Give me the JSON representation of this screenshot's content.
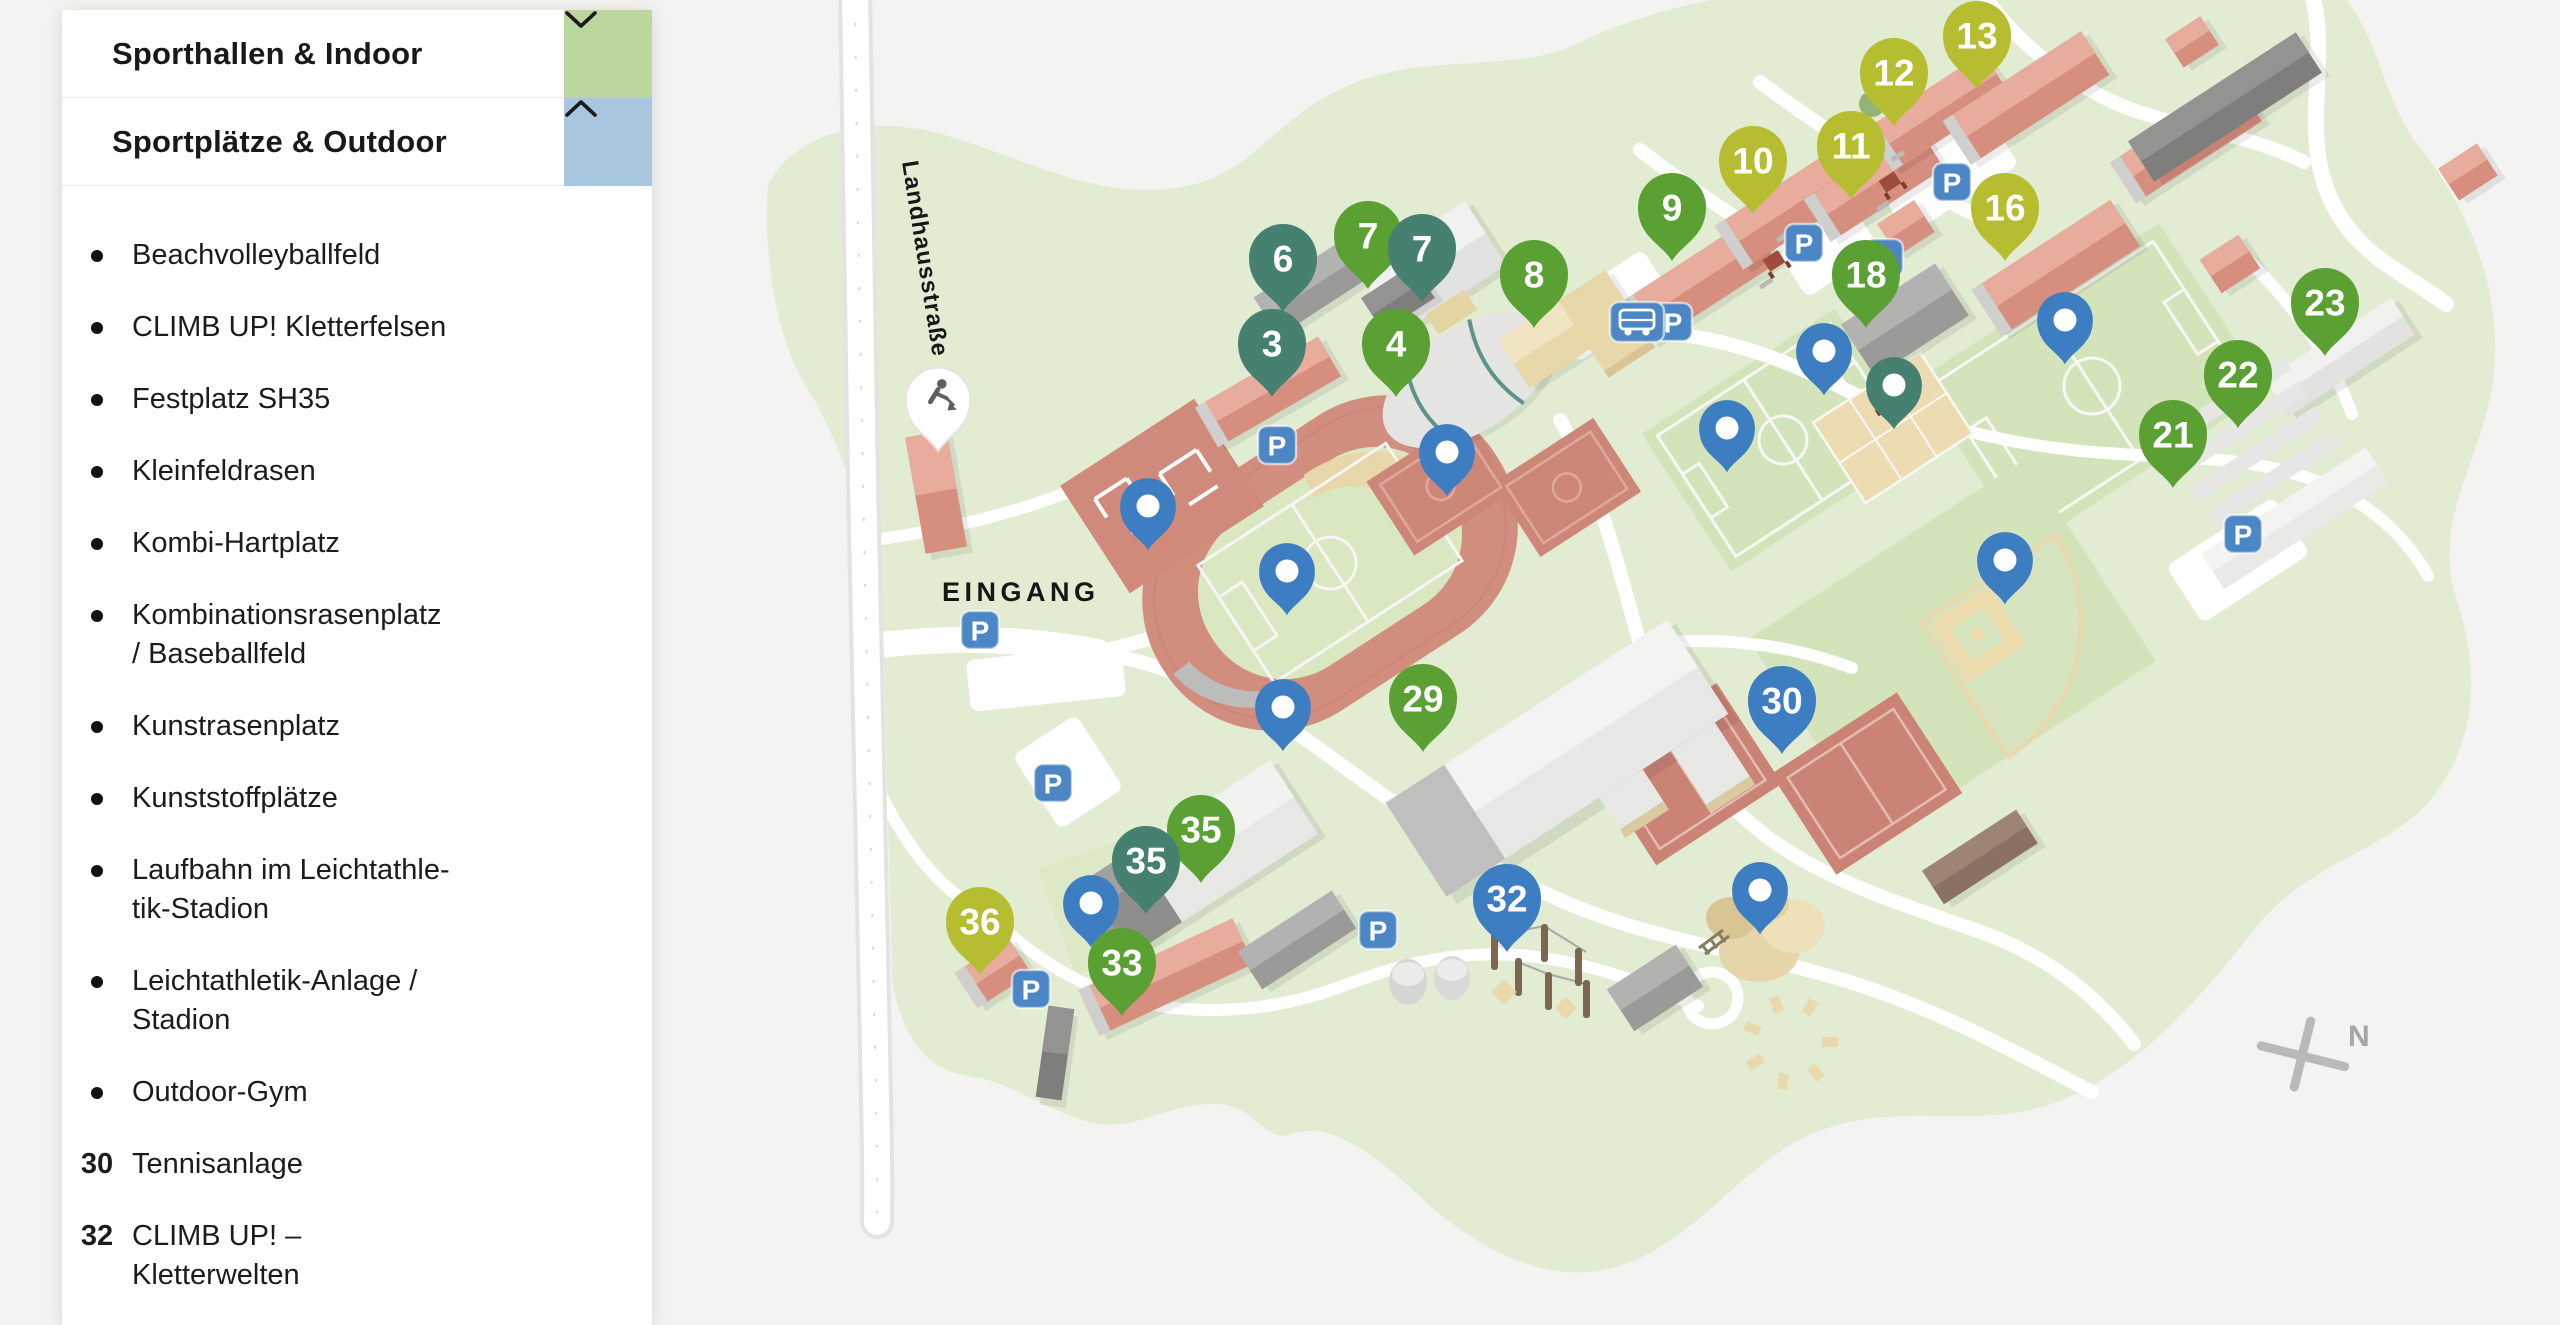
{
  "sidebar": {
    "sections": [
      {
        "label": "Sporthallen & Indoor",
        "chevron": "down",
        "expanded": false
      },
      {
        "label": "Sportplätze & Outdoor",
        "chevron": "up",
        "expanded": true
      }
    ],
    "outdoor_items": [
      {
        "bullet": "dot",
        "label": "Beachvolleyballfeld"
      },
      {
        "bullet": "dot",
        "label": "CLIMB UP! Kletterfelsen"
      },
      {
        "bullet": "dot",
        "label": "Festplatz SH35"
      },
      {
        "bullet": "dot",
        "label": "Kleinfeldrasen"
      },
      {
        "bullet": "dot",
        "label": "Kombi-Hartplatz"
      },
      {
        "bullet": "dot",
        "label": "Kombinationsrasenplatz\n/ Baseballfeld"
      },
      {
        "bullet": "dot",
        "label": "Kunstrasenplatz"
      },
      {
        "bullet": "dot",
        "label": "Kunststoffplätze"
      },
      {
        "bullet": "dot",
        "label": "Laufbahn im Leichtathle-\ntik-Stadion"
      },
      {
        "bullet": "dot",
        "label": "Leichtathletik-Anlage /\nStadion"
      },
      {
        "bullet": "dot",
        "label": "Outdoor-Gym"
      },
      {
        "bullet": "30",
        "label": "Tennisanlage"
      },
      {
        "bullet": "32",
        "label": "CLIMB UP! –\nKletterwelten"
      }
    ]
  },
  "map": {
    "labels": {
      "entrance": "EINGANG",
      "street": "Landhausstraße",
      "north": "N",
      "parking": "P"
    },
    "marker_colors": {
      "green": "#5ba033",
      "olive": "#b6bd30",
      "teal": "#468070",
      "blue": "#3d7dc2"
    },
    "numbered_markers": [
      {
        "num": "13",
        "x": 1977,
        "y": 35,
        "color": "olive"
      },
      {
        "num": "12",
        "x": 1894,
        "y": 72,
        "color": "olive"
      },
      {
        "num": "11",
        "x": 1851,
        "y": 145,
        "color": "olive"
      },
      {
        "num": "10",
        "x": 1753,
        "y": 160,
        "color": "olive"
      },
      {
        "num": "9",
        "x": 1672,
        "y": 207,
        "color": "green"
      },
      {
        "num": "16",
        "x": 2005,
        "y": 207,
        "color": "olive"
      },
      {
        "num": "7",
        "x": 1368,
        "y": 235,
        "color": "green"
      },
      {
        "num": "7",
        "x": 1422,
        "y": 248,
        "color": "teal"
      },
      {
        "num": "6",
        "x": 1283,
        "y": 258,
        "color": "teal"
      },
      {
        "num": "8",
        "x": 1534,
        "y": 274,
        "color": "green"
      },
      {
        "num": "18",
        "x": 1866,
        "y": 274,
        "color": "green"
      },
      {
        "num": "3",
        "x": 1272,
        "y": 343,
        "color": "teal"
      },
      {
        "num": "4",
        "x": 1396,
        "y": 343,
        "color": "green"
      },
      {
        "num": "23",
        "x": 2325,
        "y": 302,
        "color": "green"
      },
      {
        "num": "22",
        "x": 2238,
        "y": 374,
        "color": "green"
      },
      {
        "num": "21",
        "x": 2173,
        "y": 434,
        "color": "green"
      },
      {
        "num": "29",
        "x": 1423,
        "y": 698,
        "color": "green"
      },
      {
        "num": "30",
        "x": 1782,
        "y": 700,
        "color": "blue"
      },
      {
        "num": "35",
        "x": 1201,
        "y": 829,
        "color": "green"
      },
      {
        "num": "35",
        "x": 1146,
        "y": 860,
        "color": "teal"
      },
      {
        "num": "36",
        "x": 980,
        "y": 921,
        "color": "olive"
      },
      {
        "num": "33",
        "x": 1122,
        "y": 962,
        "color": "green"
      },
      {
        "num": "32",
        "x": 1507,
        "y": 898,
        "color": "blue"
      }
    ],
    "dot_markers": [
      {
        "x": 2065,
        "y": 320,
        "color": "blue"
      },
      {
        "x": 1824,
        "y": 351,
        "color": "blue"
      },
      {
        "x": 1894,
        "y": 385,
        "color": "teal"
      },
      {
        "x": 1727,
        "y": 428,
        "color": "blue"
      },
      {
        "x": 1447,
        "y": 452,
        "color": "blue"
      },
      {
        "x": 1148,
        "y": 506,
        "color": "blue"
      },
      {
        "x": 1287,
        "y": 571,
        "color": "blue"
      },
      {
        "x": 2005,
        "y": 560,
        "color": "blue"
      },
      {
        "x": 1283,
        "y": 707,
        "color": "blue"
      },
      {
        "x": 1760,
        "y": 890,
        "color": "blue"
      },
      {
        "x": 1091,
        "y": 903,
        "color": "blue"
      }
    ],
    "construction_marker": {
      "x": 938,
      "y": 400
    },
    "parking_positions": [
      [
        1277,
        445
      ],
      [
        980,
        630
      ],
      [
        1053,
        783
      ],
      [
        1031,
        989
      ],
      [
        1378,
        930
      ],
      [
        1673,
        322
      ],
      [
        1952,
        182
      ],
      [
        1804,
        243
      ],
      [
        1884,
        258
      ],
      [
        2243,
        534
      ]
    ],
    "bus_stop": {
      "x": 1637,
      "y": 322
    }
  }
}
